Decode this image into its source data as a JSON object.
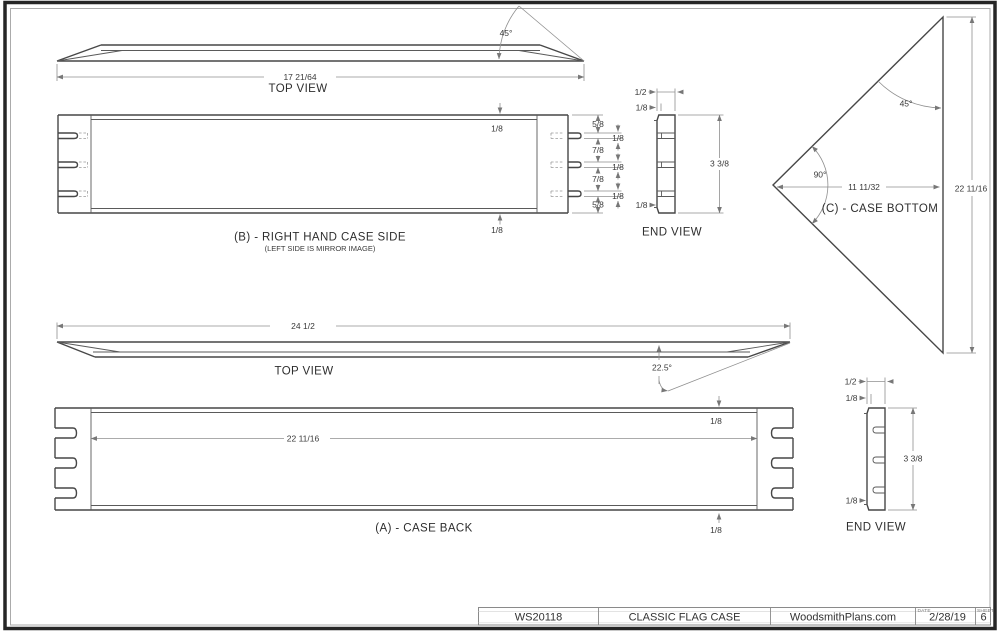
{
  "views": {
    "top_view_b": {
      "title": "TOP VIEW",
      "angle_label": "45°",
      "length_label": "17 21/64"
    },
    "case_side_b": {
      "title": "(B) - RIGHT HAND CASE SIDE",
      "subtitle": "(LEFT SIDE IS MIRROR IMAGE)",
      "edge_top": "1/8",
      "edge_bottom": "1/8",
      "segment_dims": [
        "5/8",
        "7/8",
        "7/8",
        "5/8"
      ],
      "slot_dims": [
        "1/8",
        "1/8",
        "1/8"
      ]
    },
    "end_view_b": {
      "title": "END VIEW",
      "width_label": "1/2",
      "lip_top": "1/8",
      "height_label": "3 3/8",
      "lip_bottom": "1/8"
    },
    "case_bottom_c": {
      "title": "(C) - CASE BOTTOM",
      "angle_top": "45°",
      "angle_left": "90°",
      "width_label": "11 11/32",
      "height_label": "22 11/16"
    },
    "top_view_a": {
      "title": "TOP VIEW",
      "length_label": "24 1/2",
      "angle_label": "22.5°"
    },
    "case_back_a": {
      "title": "(A) - CASE BACK",
      "width_label": "22 11/16",
      "lip_top": "1/8",
      "lip_bottom": "1/8"
    },
    "end_view_a": {
      "title": "END VIEW",
      "width_label": "1/2",
      "lip_top": "1/8",
      "height_label": "3 3/8",
      "lip_bottom": "1/8"
    }
  },
  "title_block": {
    "plan_number": "WS20118",
    "plan_title": "CLASSIC FLAG CASE",
    "website": "WoodsmithPlans.com",
    "date_label": "DATE",
    "date_value": "2/28/19",
    "sheet_label": "SHEET",
    "sheet_value": "6"
  },
  "colors": {
    "background": "#ffffff",
    "object_line": "#474747",
    "secondary_line": "#5a5a5a",
    "dimension_line": "#8f8f8f",
    "arrow": "#777777",
    "text": "#3a3a3a",
    "border_outer": "#262626",
    "border_inner": "#ababab"
  }
}
